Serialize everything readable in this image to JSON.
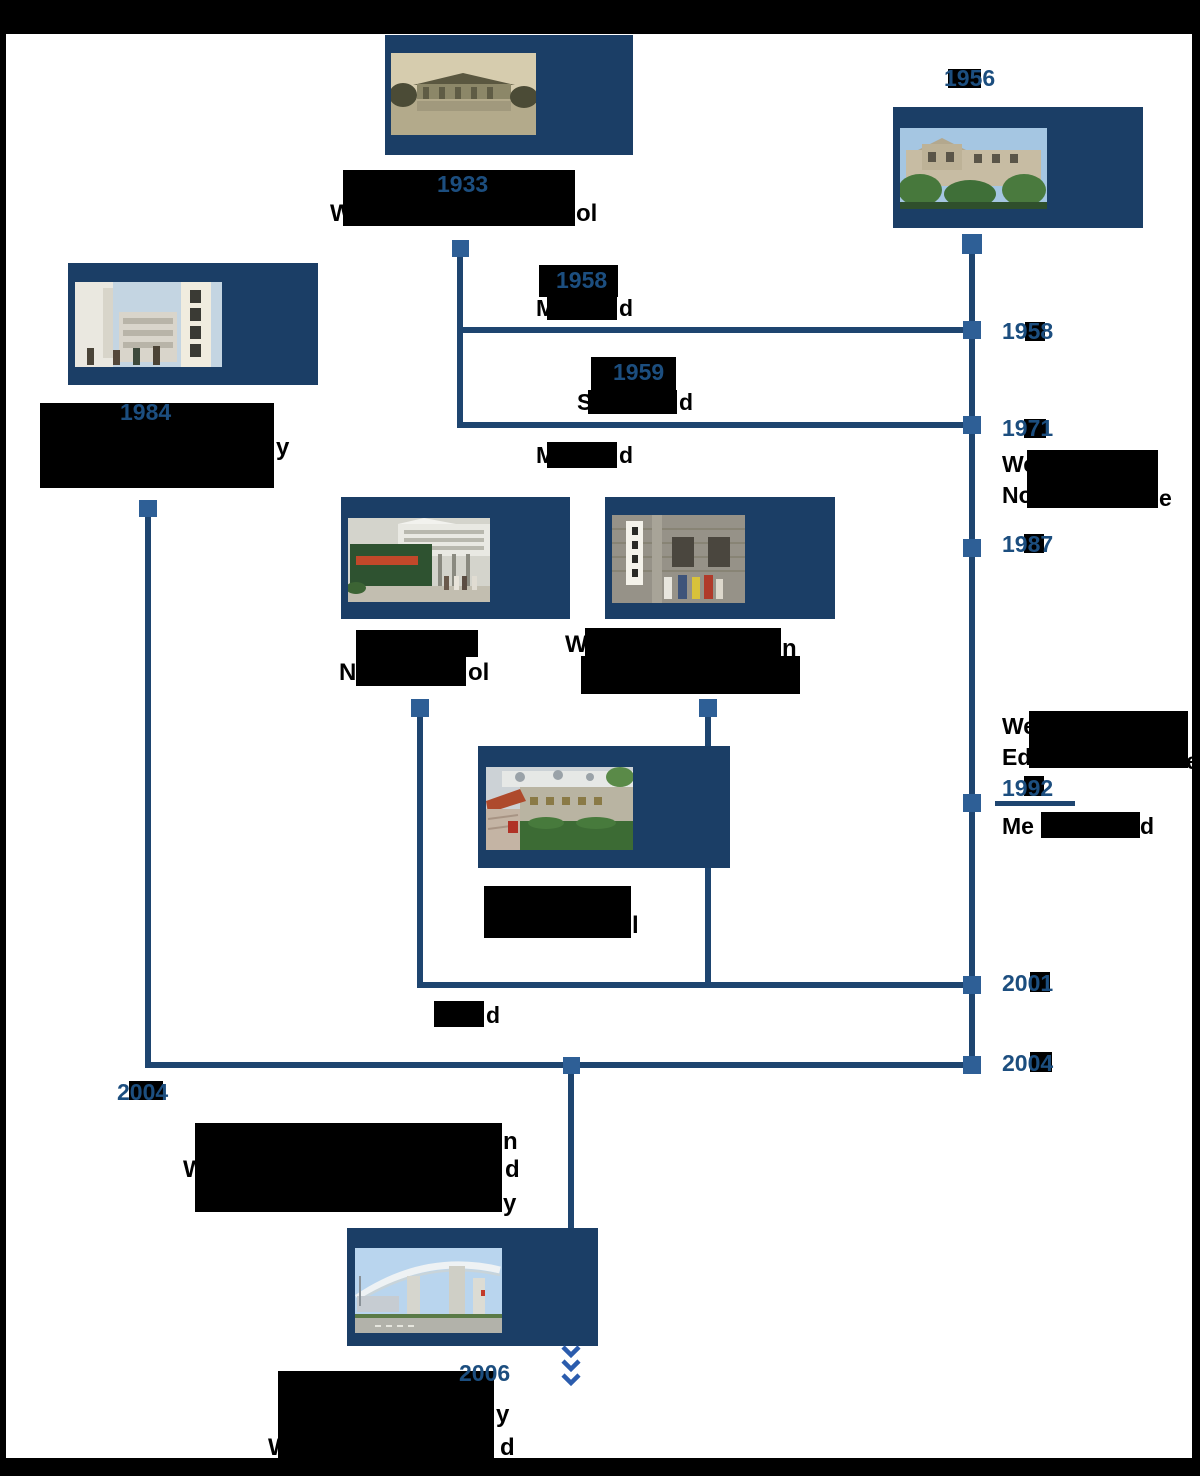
{
  "colors": {
    "photo_frame": "#1b3e66",
    "connector_line": "#1e4570",
    "node_square": "#2e5f96",
    "year_blue": "#1c4e7f",
    "redaction_black": "#000000",
    "chevron_blue": "#2b5cad"
  },
  "years": {
    "y1933": "1933",
    "y1956": "1956",
    "y1984": "1984",
    "m1958": "1958",
    "s1959": "1959",
    "left2004": "2004",
    "y2006": "2006"
  },
  "fragments": {
    "cap1933_p": "W",
    "cap1933_s": "ol",
    "cap1984_s": "y",
    "m1958_p": "M",
    "m1958_s": "d",
    "s1959_p": "S",
    "s1959_s": "d",
    "m1971_p": "M",
    "m1971_s": "d",
    "ruian_p": "N",
    "ruian_s": "ol",
    "edu_p": "W",
    "edu_s": "n",
    "pingyang_s": "l",
    "m2001_s": "d",
    "big_s1": "n",
    "big_p2": "W",
    "big_s2": "d",
    "big_s3": "y",
    "b2006_s2": "y",
    "b2006_p3": "W",
    "b2006_s3": "d"
  },
  "timeline": {
    "t1958": "1958",
    "t1971": "1971",
    "t1987": "1987",
    "t1992": "1992",
    "t2001": "2001",
    "t2004": "2004",
    "t1971_l1": "We",
    "t1971_l2p": "No",
    "t1971_l2s": "e",
    "t1992_l1": "We",
    "t1992_l2p": "Ed",
    "t1992_l2s": "e",
    "t1992_wp": "Me",
    "t1992_ws": "d"
  }
}
